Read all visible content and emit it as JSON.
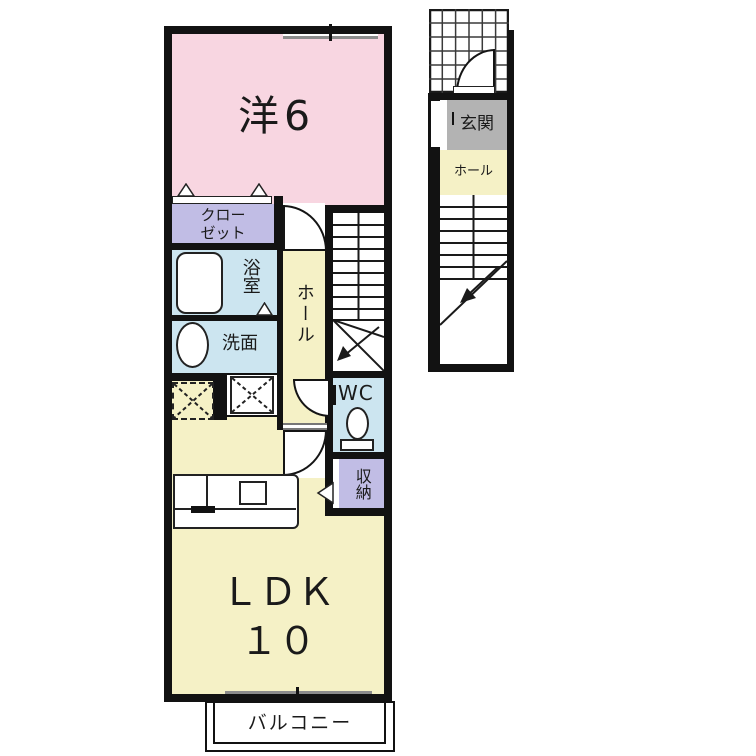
{
  "colors": {
    "room-pink": "#F8D6E1",
    "room-lavender": "#C1BDE5",
    "room-blue": "#CCE5F0",
    "room-yellow": "#F5F1C6",
    "room-gray": "#B3B3B3",
    "wall": "#121212",
    "window": "#8C8C8C"
  },
  "main_floor": {
    "rooms": {
      "western": {
        "label": "洋6"
      },
      "closet": {
        "label_line1": "クロー",
        "label_line2": "ゼット"
      },
      "bath": {
        "label": "浴室"
      },
      "washroom": {
        "label": "洗面"
      },
      "hall": {
        "label": "ホール"
      },
      "wc": {
        "label": "WC"
      },
      "storage": {
        "label": "収納"
      },
      "ldk": {
        "label_line1": "ＬＤＫ",
        "label_line2": "１０"
      },
      "balcony": {
        "label": "バルコニー"
      }
    }
  },
  "entrance_floor": {
    "rooms": {
      "genkan": {
        "label": "玄関"
      },
      "hall": {
        "label": "ホール"
      }
    }
  }
}
